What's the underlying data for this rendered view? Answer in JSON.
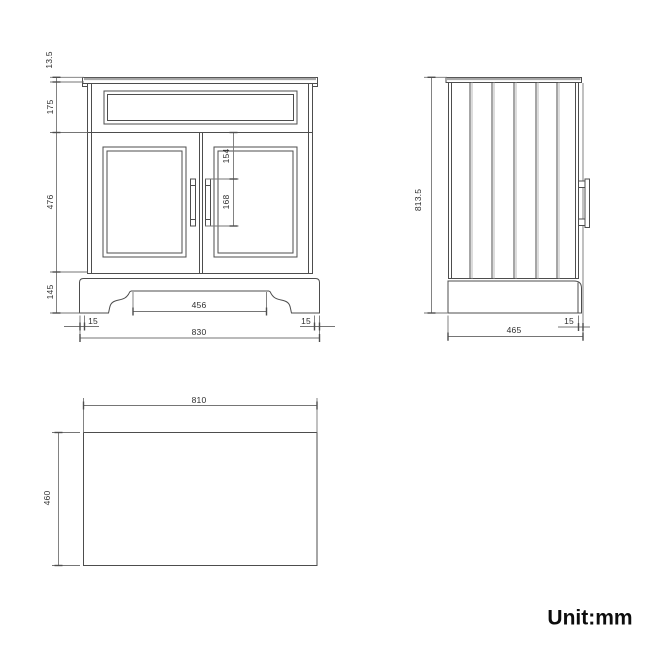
{
  "front_view": {
    "dimensions": {
      "countertop_thickness": "13.5",
      "top_rail_height": "175",
      "door_height": "476",
      "plinth_height": "145",
      "handle_top_offset": "154",
      "handle_height": "168",
      "plinth_cutout_width": "456",
      "bottom_left_inset": "15",
      "bottom_right_inset": "15",
      "overall_width": "830"
    }
  },
  "side_view": {
    "dimensions": {
      "overall_height": "813.5",
      "front_inset": "15",
      "overall_depth": "465"
    }
  },
  "top_view": {
    "dimensions": {
      "width": "810",
      "depth": "460"
    }
  },
  "footer": {
    "unit_label": "Unit:mm"
  },
  "colors": {
    "object_line": "#4d4d4d",
    "dimension_line": "#757575",
    "shadow_line": "#b8b8b8",
    "text": "#2e2e2e",
    "background": "#ffffff"
  }
}
